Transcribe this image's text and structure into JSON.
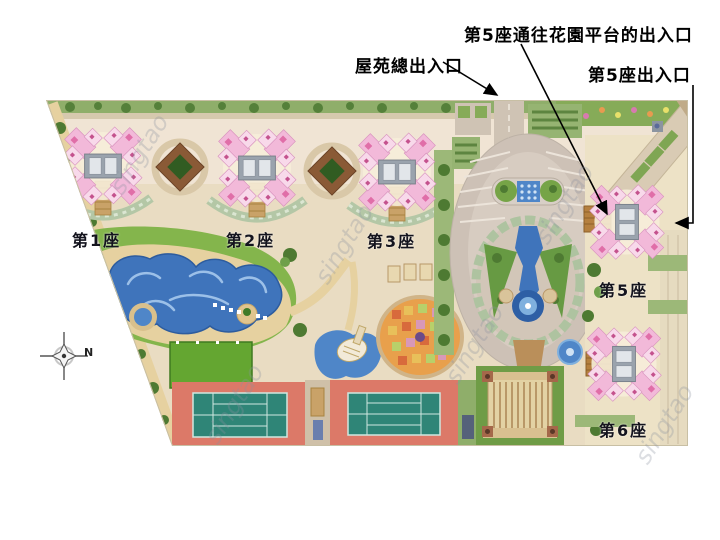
{
  "annotations": {
    "garden_platform_entrance_label": "第5座通往花園平台的出入口",
    "estate_main_entrance_label": "屋苑總出入口",
    "block5_entrance_label": "第5座出入口"
  },
  "blocks": {
    "b1": "第1座",
    "b2": "第2座",
    "b3": "第3座",
    "b5": "第5座",
    "b6": "第6座"
  },
  "compass": {
    "north": "N"
  },
  "watermark": {
    "text": "singtao"
  },
  "colors": {
    "building_pink": "#f2b9d9",
    "building_pink_light": "#f8d9ea",
    "building_pink_dark": "#e06ea8",
    "core_grey": "#9aa3ad",
    "lawn_green": "#84b54c",
    "tree_green": "#4e7a32",
    "terrace_sage": "#b4c7a6",
    "pool_blue": "#3f74bb",
    "fountain_blue": "#4f86c8",
    "sand_deck": "#e6d1a0",
    "court_red": "#dc7968",
    "court_teal": "#2f8577",
    "road_tan": "#cdc1b6",
    "paving_cream": "#ece0c8",
    "stair_tan": "#c9a268",
    "platform_brown": "#b5803f",
    "diamond_brown": "#8a5a36",
    "annotation_text": "#000000"
  }
}
